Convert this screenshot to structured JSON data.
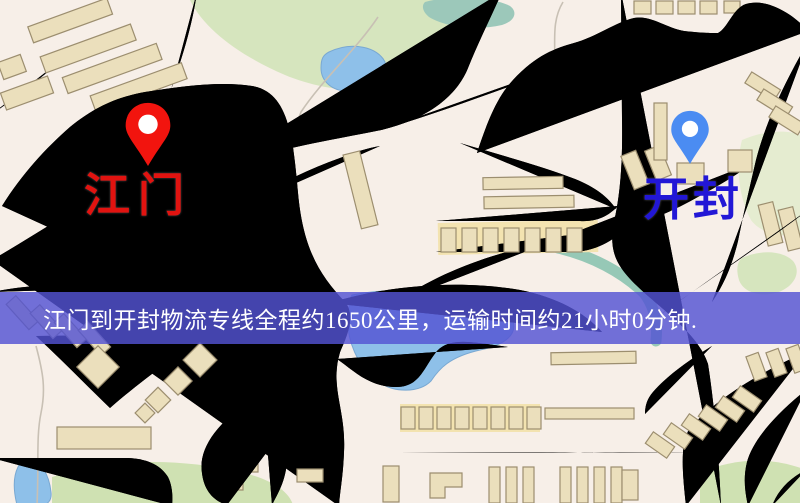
{
  "image": {
    "width": 800,
    "height": 503,
    "type": "static-route-map"
  },
  "map": {
    "markers": [
      {
        "id": "origin",
        "label": "江门",
        "pin_color": "#f2140e",
        "label_color": "#e11310"
      },
      {
        "id": "destination",
        "label": "开封",
        "pin_color": "#4b8cf2",
        "label_color": "#2217d6"
      }
    ]
  },
  "banner": {
    "text": "江门到开封物流专线全程约1650公里，运输时间约21小时0分钟.",
    "background_color": "#5353d3",
    "text_color": "#ffffff"
  },
  "icons": {
    "origin": "map-pin-icon",
    "destination": "map-pin-icon"
  },
  "palette": {
    "background": "#f7efe8",
    "road": "#f6d67c",
    "road_casing": "#e3ba62",
    "building": "#ebdfbc",
    "park": "#d6e5be",
    "water": "#8ec0e9",
    "railway": "#262626"
  }
}
